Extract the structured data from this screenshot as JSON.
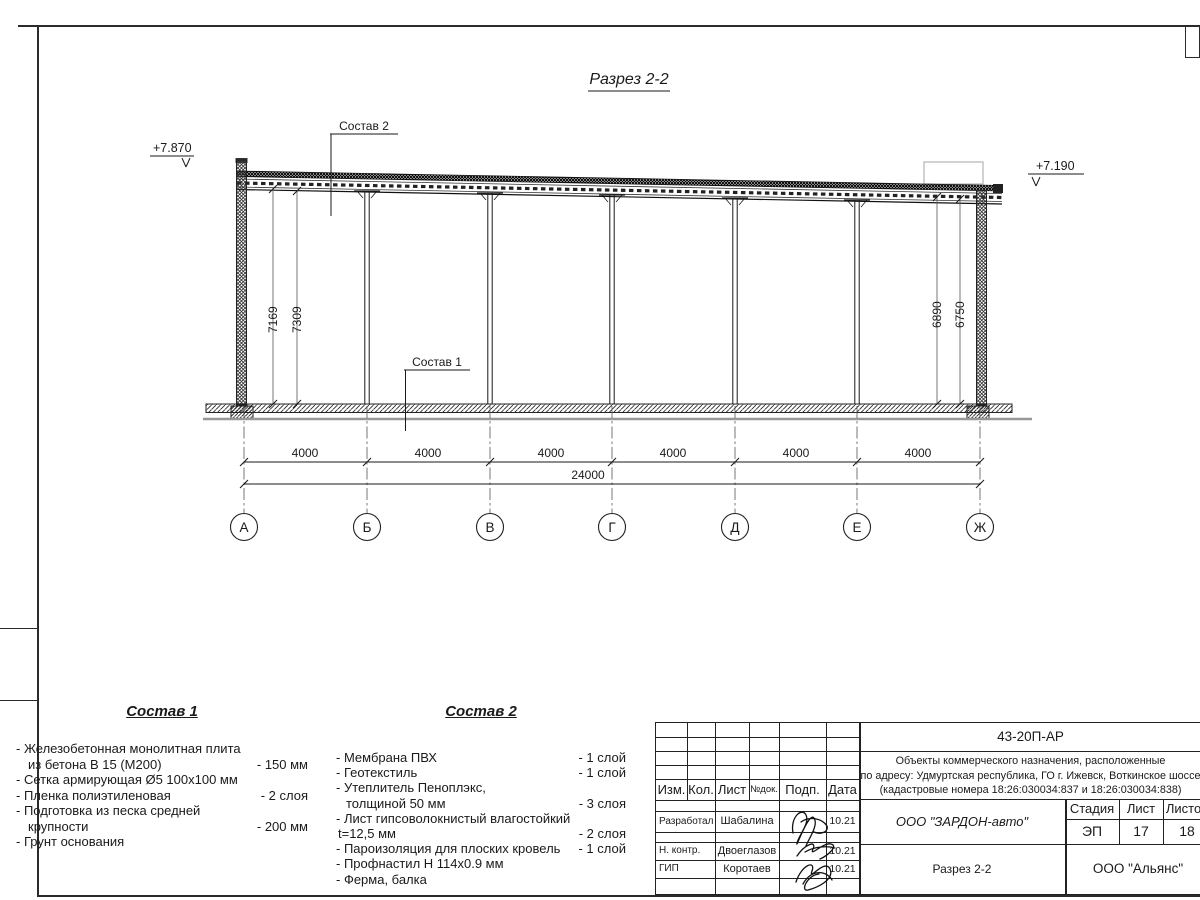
{
  "title": "Разрез 2-2",
  "drawing": {
    "elevation_left": "+7.870",
    "elevation_right": "+7.190",
    "callout_top": "Состав 2",
    "callout_floor": "Состав 1",
    "vertical_dims": [
      "7169",
      "7309",
      "6890",
      "6750"
    ],
    "bay_dims": [
      "4000",
      "4000",
      "4000",
      "4000",
      "4000",
      "4000"
    ],
    "total_dim": "24000",
    "axes": [
      "А",
      "Б",
      "В",
      "Г",
      "Д",
      "Е",
      "Ж"
    ]
  },
  "comp1": {
    "heading": "Состав 1",
    "rows": [
      {
        "text": "- Железобетонная  монолитная плита",
        "value": ""
      },
      {
        "text": "из бетона В 15 (М200)",
        "value": "- 150 мм"
      },
      {
        "text": "- Сетка армирующая Ø5 100х100 мм",
        "value": ""
      },
      {
        "text": "- Пленка полиэтиленовая",
        "value": "-  2 слоя"
      },
      {
        "text": "- Подготовка из песка средней",
        "value": ""
      },
      {
        "text": "крупности",
        "value": "- 200 мм"
      },
      {
        "text": "- Грунт основания",
        "value": ""
      }
    ]
  },
  "comp2": {
    "heading": "Состав 2",
    "rows": [
      {
        "text": "- Мембрана ПВХ",
        "value": "- 1 слой"
      },
      {
        "text": "- Геотекстиль",
        "value": "- 1 слой"
      },
      {
        "text": "- Утеплитель Пеноплэкс,",
        "value": ""
      },
      {
        "text": "толщиной 50 мм",
        "value": "- 3 слоя"
      },
      {
        "text": "- Лист гипсоволокнистый влагостойкий",
        "value": ""
      },
      {
        "text": "t=12,5 мм",
        "value": "- 2 слоя"
      },
      {
        "text": "- Пароизоляция для плоских кровель",
        "value": "- 1 слой"
      },
      {
        "text": "- Профнастил Н 114х0.9 мм",
        "value": ""
      },
      {
        "text": "- Ферма, балка",
        "value": ""
      }
    ]
  },
  "stamp": {
    "doc_number": "43-20П-АР",
    "project_line1": "Объекты коммерческого назначения, расположенные",
    "project_line2": "по адресу: Удмуртская республика, ГО г. Ижевск, Воткинское шоссе",
    "project_line3": "(кадастровые номера 18:26:030034:837 и 18:26:030034:838)",
    "header": {
      "izm": "Изм.",
      "kol": "Кол.",
      "list": "Лист",
      "ndok": "№док.",
      "podp": "Подп.",
      "data": "Дата"
    },
    "roles": [
      {
        "role": "Разработал",
        "name": "Шабалина",
        "date": "10.21"
      },
      {
        "role": "Н. контр.",
        "name": "Двоеглазов",
        "date": "10.21"
      },
      {
        "role": "ГИП",
        "name": "Коротаев",
        "date": "10.21"
      }
    ],
    "stage_header": {
      "stage": "Стадия",
      "sheet": "Лист",
      "sheets": "Листов"
    },
    "stage_values": {
      "stage": "ЭП",
      "sheet": "17",
      "sheets": "18"
    },
    "client": "ООО \"ЗАРДОН-авто\"",
    "sheet_title": "Разрез 2-2",
    "contractor": "ООО \"Альянс\""
  }
}
